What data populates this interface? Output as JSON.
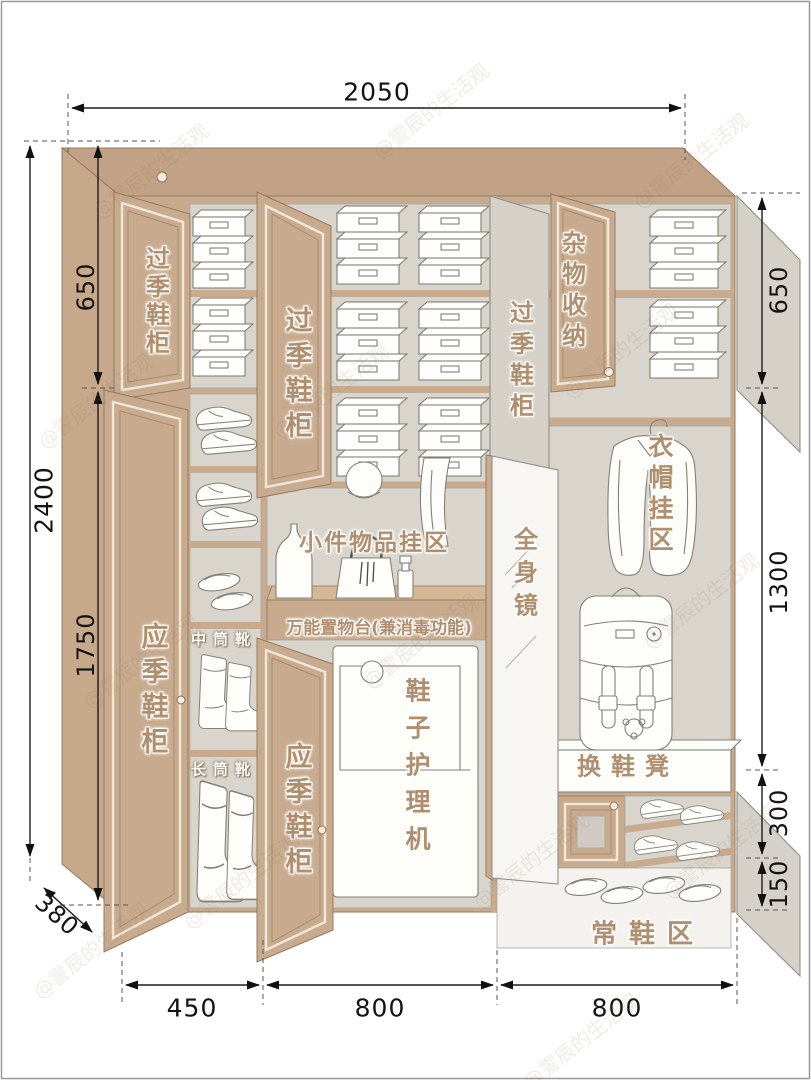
{
  "watermark": {
    "text": "@霅辰的生活观"
  },
  "dimensions": {
    "total_width": "2050",
    "total_height": "2400",
    "left_top": "650",
    "left_bottom": "1750",
    "right_top": "650",
    "right_middle": "1300",
    "right_lower": "300",
    "right_bottom": "150",
    "bottom_left": "450",
    "bottom_middle": "800",
    "bottom_right": "800",
    "depth": "380"
  },
  "labels": {
    "offseason_left": "过季鞋柜",
    "offseason_mid": "过季鞋柜",
    "offseason_right": "过季鞋柜",
    "misc_storage": "杂物收纳",
    "coat_zone": "衣帽挂区",
    "inseason_left": "应季鞋柜",
    "inseason_mid": "应季鞋柜",
    "mid_boots": "中筒靴",
    "tall_boots": "长筒靴",
    "small_items": "小件物品挂区",
    "utility_counter": "万能置物台(兼消毒功能)",
    "shoe_care": "鞋子护理机",
    "mirror": "全身镜",
    "bench": "换鞋凳",
    "daily_shoes": "常鞋区"
  }
}
